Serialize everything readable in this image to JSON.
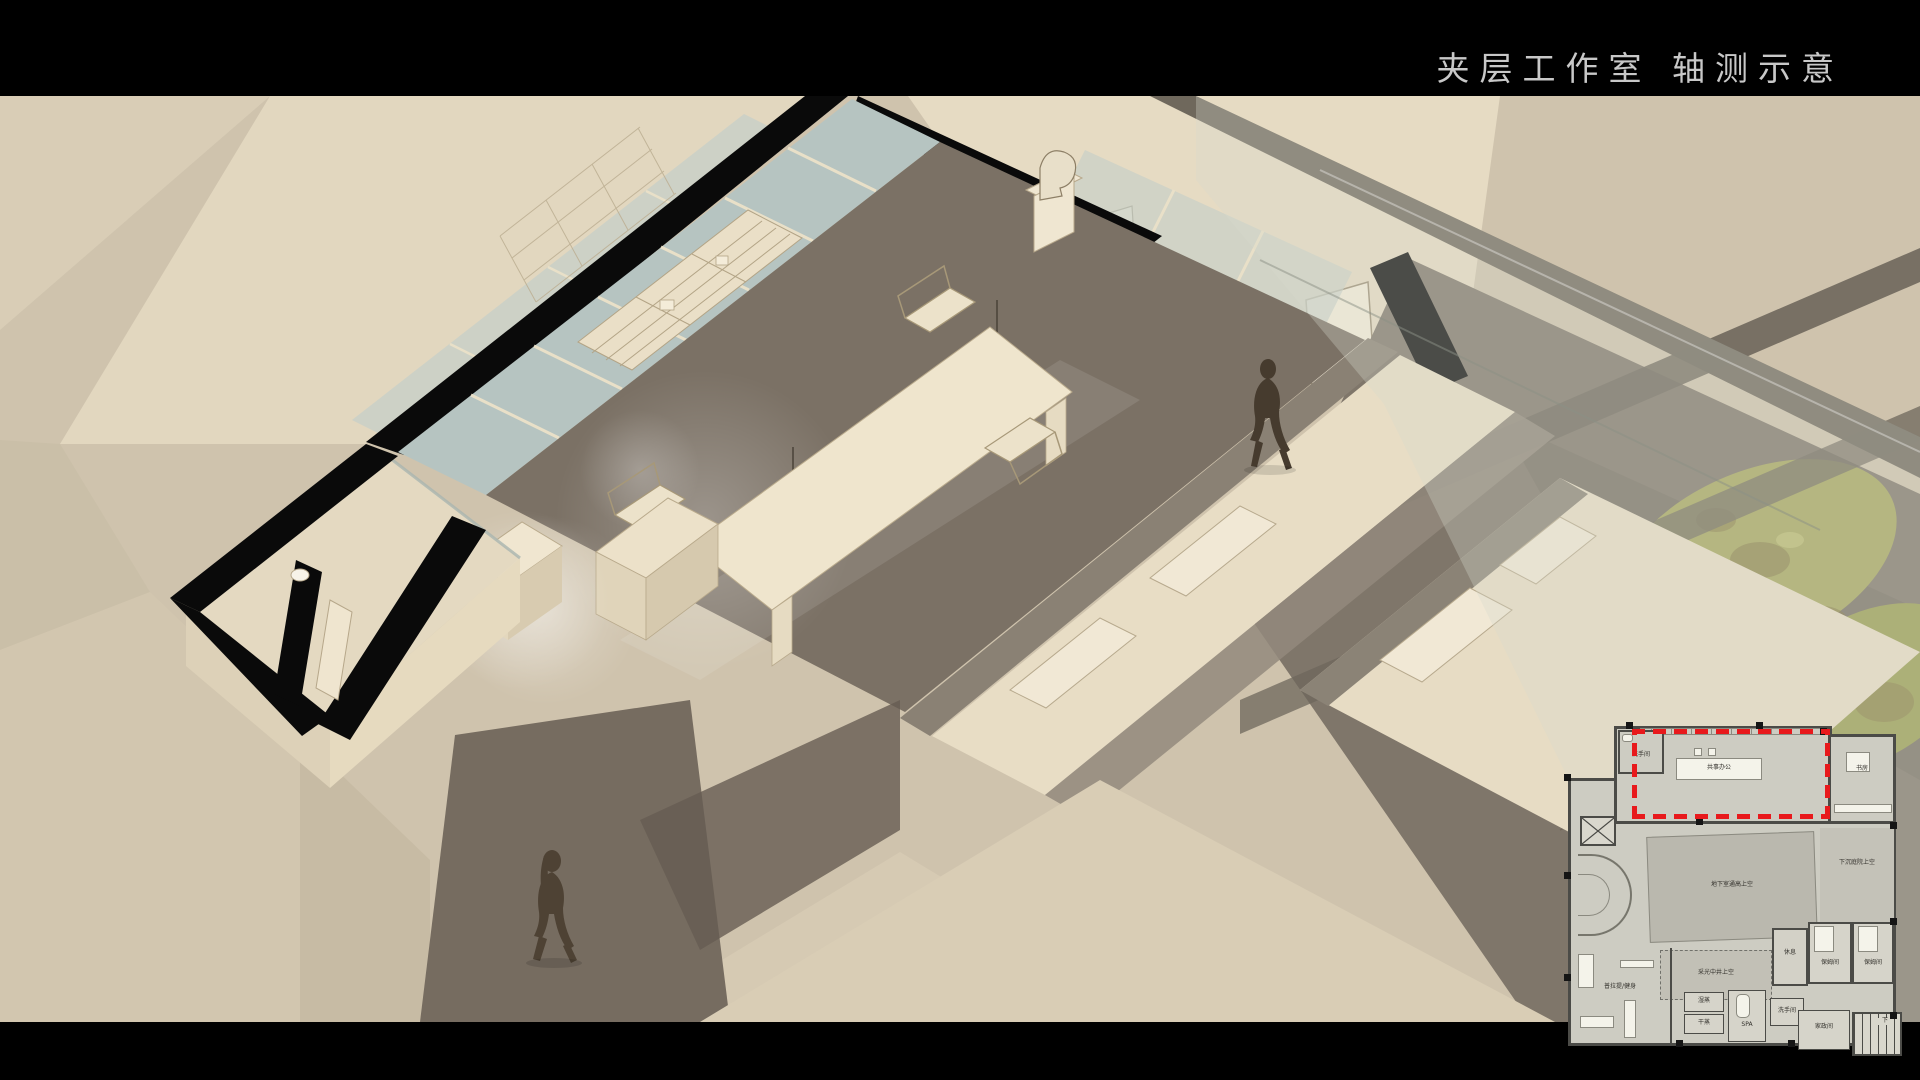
{
  "header": {
    "title": "夹层工作室 轴测示意"
  },
  "colors": {
    "background_paper": "#cfc3ad",
    "band_black": "#000000",
    "wall_cream": "#e9dec7",
    "floor_dark": "#7b7165",
    "glass_blue": "#b6c4c1",
    "tree_green": "#a5a65d",
    "silhouette_brown": "#4a3e31",
    "plan_highlight_red": "#e8191c"
  },
  "plan": {
    "rooms": {
      "washroom_top": "洗手间",
      "studio_office": "共事办公",
      "study": "书房",
      "basement_void": "地下室通高上空",
      "sunken_courtyard_void": "下沉庭院上空",
      "lightwell_void": "采光中井上空",
      "rest": "休息",
      "nanny_1": "保姆间",
      "nanny_2": "保姆间",
      "pilates": "普拉提/健身",
      "wet_steam": "湿蒸",
      "dry_steam": "干蒸",
      "spa": "SPA",
      "washroom_bottom": "洗手间",
      "housekeeping": "家政间",
      "stair_down": "下"
    }
  }
}
